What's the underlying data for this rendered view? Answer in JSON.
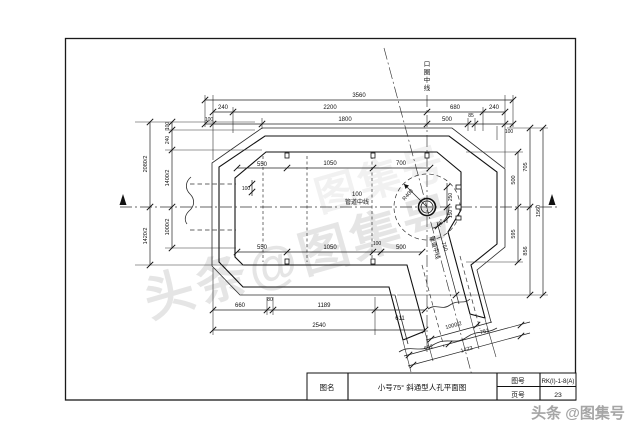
{
  "labels": {
    "kou_quan": {
      "c1": "口",
      "c2": "圈",
      "c3": "中",
      "c4": "线"
    },
    "pipe_center_100": "100",
    "pipe_center_text": "管道中线",
    "pipe_center_diag": "管道中线",
    "radius": "R400",
    "angle": "75°"
  },
  "dims": {
    "top_total": "3560",
    "top_240_l": "240",
    "top_2200": "2200",
    "top_680": "680",
    "top_240_r": "240",
    "top_100_l": "100",
    "top_1800": "1800",
    "top_500": "500",
    "top_85": "85",
    "top_100_r": "100",
    "left_2080_2": "2080/2",
    "left_1420_2": "1420/2",
    "left_100": "100",
    "left_240": "240",
    "left_1400_2": "1400/2",
    "left_1000_2": "1000/2",
    "right_500": "500",
    "right_595": "595",
    "right_705": "705",
    "right_856": "856",
    "right_1560": "1560",
    "bot_660": "660",
    "bot_80": "80",
    "bot_1189": "1189",
    "bot_611": "611",
    "bot_2540": "2540",
    "in_top_550": "550",
    "in_top_1050": "1050",
    "in_top_700": "700",
    "in_bot_550": "550",
    "in_bot_1050": "1050",
    "in_bot_100": "100",
    "in_bot_500": "500",
    "in_left_100": "100",
    "wall_250": "250",
    "wall_150": "150",
    "diag_750": "750",
    "sk_1000_2": "1000/2",
    "sk_761": "761",
    "sk_662": "662",
    "sk_1423": "1423"
  },
  "titleblock": {
    "name_label": "图名",
    "drawing_title": "小号75° 斜通型人孔平面图",
    "no_label": "图号",
    "no_value": "RK(I)-1-8(A)",
    "page_label": "页号",
    "page_value": "23"
  },
  "watermark": {
    "footer": "头条 @图集号",
    "diagonal": "头条@图集号",
    "diagonal2": "图集号"
  }
}
